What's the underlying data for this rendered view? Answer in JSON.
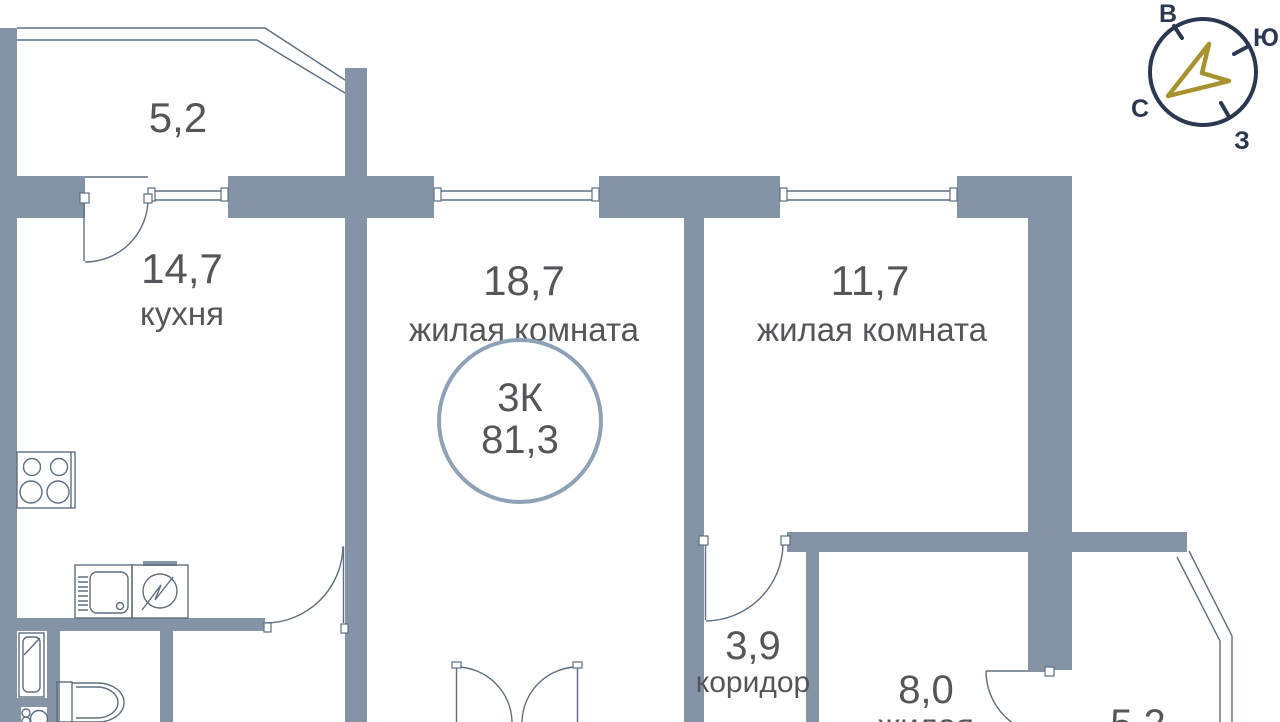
{
  "plan": {
    "badge": {
      "rooms": "3К",
      "area": "81,3"
    },
    "rooms": [
      {
        "key": "balcony-top",
        "area": "5,2",
        "name": ""
      },
      {
        "key": "kitchen",
        "area": "14,7",
        "name": "кухня"
      },
      {
        "key": "living-room-1",
        "area": "18,7",
        "name": "жилая комната"
      },
      {
        "key": "living-room-2",
        "area": "11,7",
        "name": "жилая комната"
      },
      {
        "key": "corridor",
        "area": "3,9",
        "name": "коридор"
      },
      {
        "key": "bedroom",
        "area": "8,0",
        "name": "жилая"
      },
      {
        "key": "balcony-bottom",
        "area": "5,2",
        "name": ""
      }
    ]
  },
  "compass": {
    "top": "В",
    "right": "Ю",
    "left": "С",
    "bottom": "З"
  },
  "colors": {
    "wall": "#8593a7",
    "line": "#5e6e80",
    "text": "#55565a",
    "badge": "#8fa1b6",
    "compass": "#2c3850",
    "arrow": "#a6922e"
  }
}
